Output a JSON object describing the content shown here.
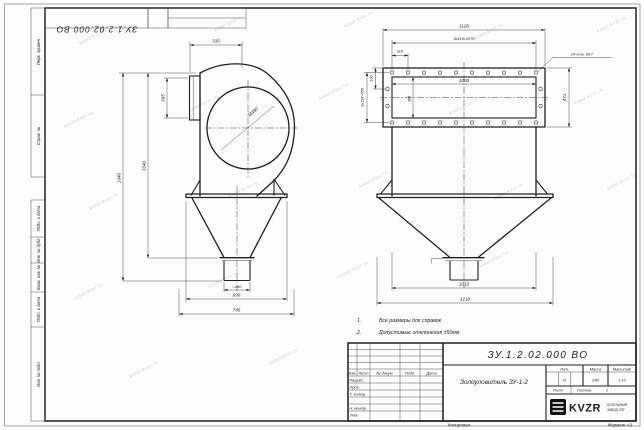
{
  "sheet": {
    "doc_number": "ЗУ.1.2.02.000 ВО",
    "copied_label": "Копировал",
    "format_label": "Формат A3"
  },
  "watermark": {
    "text": "kotel-kvzr.ru"
  },
  "margin_labels": {
    "perv_primen": "Перв. примен.",
    "sprav_no": "Справ. №",
    "podp_data_top": "Подп. и дата",
    "inv_dubl": "Инв. № дубл.",
    "vzam_inv": "Взам. инв. №",
    "podp_data_bottom": "Подп. и дата",
    "inv_podl": "Инв. № подл."
  },
  "front_view": {
    "dim_335": "335",
    "dim_365": "365",
    "dim_1640": "1640",
    "dim_1040": "1040",
    "dim_circle": "Ø380",
    "dim_outlet": "□260",
    "dim_690": "690",
    "dim_745": "745"
  },
  "side_view": {
    "dim_1126": "1126",
    "dim_pitch_row": "9x119=1070",
    "dim_119": "119",
    "dim_100": "100",
    "dim_1000": "1000",
    "dim_385": "385",
    "dim_side_pitch": "3x118=355",
    "dim_471": "471",
    "holes_note": "24 отв. Ø17",
    "dim_1010": "1010",
    "dim_1210": "1210"
  },
  "notes": [
    {
      "num": "1.",
      "text": "Все размеры для справок"
    },
    {
      "num": "2.",
      "text": "Допустимые отклонения ±50мм"
    }
  ],
  "title_block": {
    "doc_number": "ЗУ.1.2.02.000 ВО",
    "title": "Золоуловитель ЗУ-1-2",
    "col_izm": "Изм.",
    "col_list": "Лист",
    "col_ndoc": "№ докум.",
    "col_podp": "Подп.",
    "col_data": "Дата",
    "row_razrab": "Разраб.",
    "row_prov": "Пров.",
    "row_tkontr": "Т. контр.",
    "row_nkontr": "Н. контр.",
    "row_utv": "Утв.",
    "lit_header": "Лит.",
    "mass_header": "Масса",
    "scale_header": "Масштаб",
    "lit_value": "И",
    "mass_value": "240",
    "scale_value": "1:10",
    "list_header": "Лист",
    "listov_header": "Листов",
    "listov_value": "1",
    "brand": "KVZR",
    "brand_line1": "КОТЕЛЬНЫЙ",
    "brand_line2": "ЗАВОД ЛЗТ"
  }
}
